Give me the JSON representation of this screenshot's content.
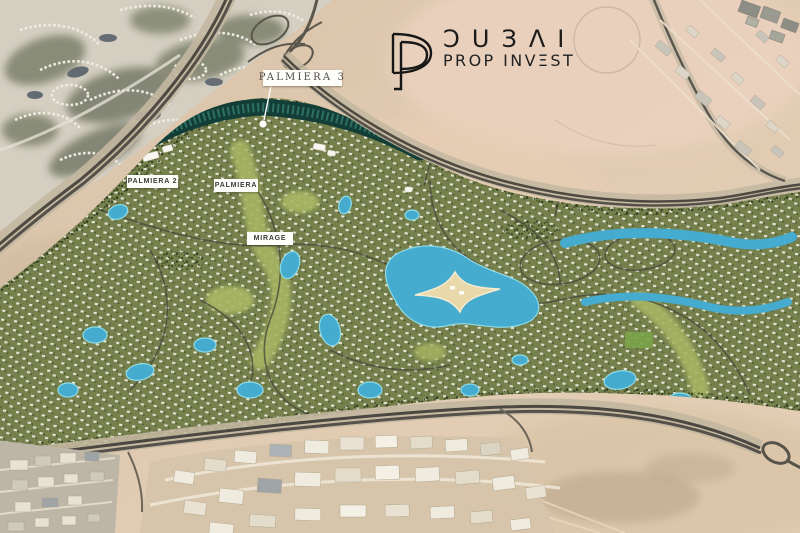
{
  "brand": {
    "monogram_letters": "DP",
    "city": "DUBAI",
    "city_display": "ƆUЗΛI",
    "tagline": "PROP INVEST",
    "tagline_display": "PROP INVΞST",
    "ink_color": "#1b1b1b"
  },
  "map": {
    "type": "masterplan-satellite-render",
    "labels": [
      {
        "id": "palmiera-3",
        "text": "PALMIERA 3"
      },
      {
        "id": "palmiera-2",
        "text": "PALMIERA 2"
      },
      {
        "id": "palmiera",
        "text": "PALMIERA"
      },
      {
        "id": "mirage",
        "text": "MIRAGE"
      }
    ],
    "colors": {
      "desert": "#dcc6ad",
      "desert_pink": "#ecd3c1",
      "community_green": "#75804d",
      "park_green": "#a6b364",
      "lake_blue": "#45abcf",
      "highlight_teal": "#133e37",
      "highway_gray": "#4b4741",
      "label_bg": "#fdfdfa"
    }
  }
}
